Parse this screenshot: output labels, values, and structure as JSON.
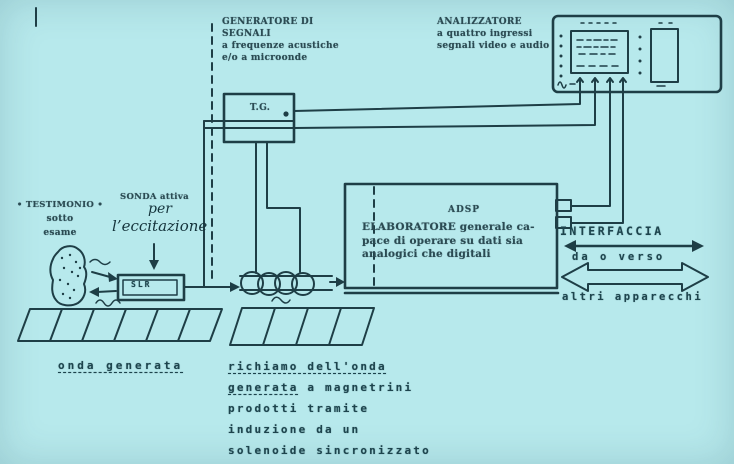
{
  "page": {
    "background": "#b7e9ec",
    "ink": "#1e3e46"
  },
  "generator_label": {
    "line1": "GENERATORE DI SEGNALI",
    "line2": "a frequenze acustiche",
    "line3": "e/o a microonde"
  },
  "analyzer_label": {
    "line1": "ANALIZZATORE",
    "line2": "a quattro ingressi",
    "line3": "segnali video e audio"
  },
  "tg_box": {
    "label": "T.G."
  },
  "specimen_label": {
    "line1": "• TESTIMONIO •",
    "line2": "sotto",
    "line3": "esame"
  },
  "probe_label": {
    "printed": "SONDA attiva",
    "handwritten1": "per",
    "handwritten2": "l’eccitazione"
  },
  "slr_box": {
    "label": "SLR"
  },
  "adsp_box": {
    "title": "ADSP",
    "body": "ELABORATORE generale ca-\npace di operare su dati sia\nanalogici che digitali"
  },
  "interface_label": {
    "title": "INTERFACCIA",
    "middle": "da o verso",
    "bottom": "altri apparecchi"
  },
  "caption_left": {
    "text": "onda generata"
  },
  "caption_right": {
    "line1": "richiamo dell'onda",
    "line2_underlined": "generata",
    "line2_rest": " a magnetrini",
    "line3": "prodotti tramite",
    "line4": "induzione da un",
    "line5": "solenoide sincronizzato"
  }
}
